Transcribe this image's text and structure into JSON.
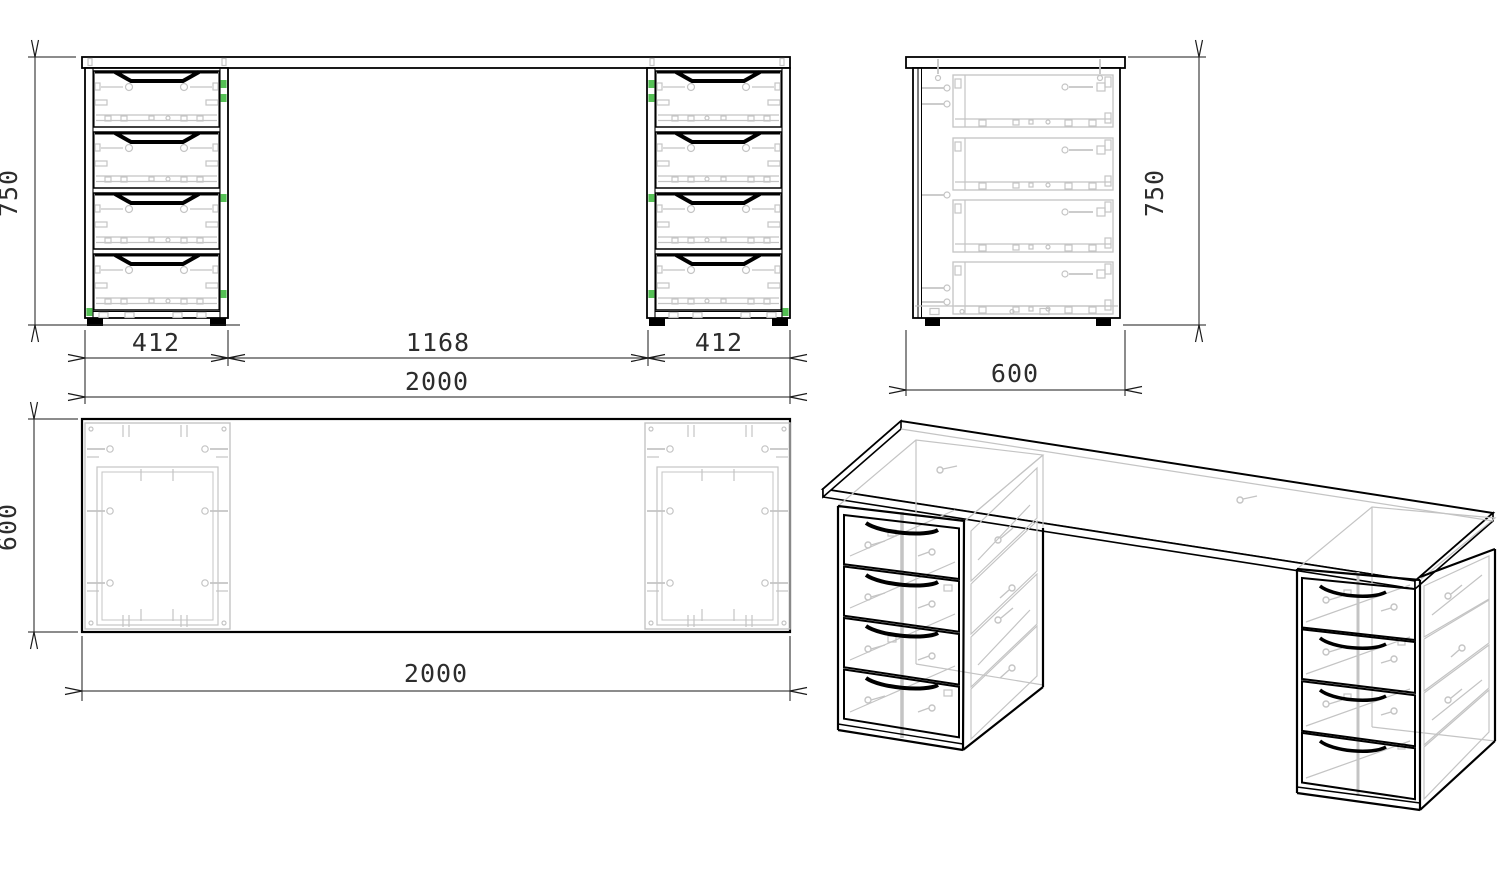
{
  "drawing": {
    "views": {
      "front": {
        "height": "750",
        "left_pedestal_width": "412",
        "center_opening_width": "1168",
        "right_pedestal_width": "412",
        "overall_width": "2000"
      },
      "side": {
        "overall_depth": "600",
        "height": "750"
      },
      "top": {
        "overall_depth": "600",
        "overall_width": "2000"
      }
    },
    "structure": {
      "pedestal_count": 2,
      "drawers_per_pedestal": 4
    },
    "colors": {
      "outline": "#000000",
      "hidden_detail_gray": "#c4c4c4",
      "hardware_highlight_green": "#55c055",
      "dimension_text": "#2d2d2d",
      "background": "#ffffff"
    }
  }
}
